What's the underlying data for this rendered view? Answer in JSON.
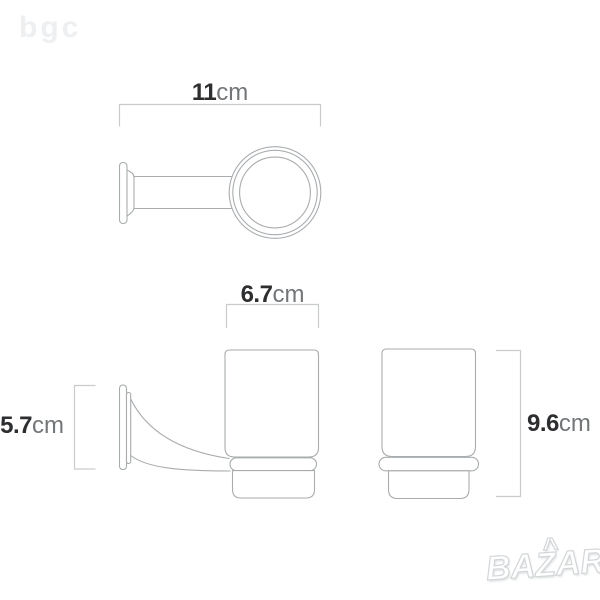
{
  "watermarks": {
    "top_left_logo": "bgc",
    "bottom_right_logo": "BAZAR",
    "bottom_right_logo_accent": "^"
  },
  "diagram": {
    "type": "product-dimension-drawing",
    "dimensions": [
      {
        "id": "holder-depth",
        "value": "11",
        "unit": "cm"
      },
      {
        "id": "cup-width",
        "value": "6.7",
        "unit": "cm"
      },
      {
        "id": "wall-plate-height",
        "value": "5.7",
        "unit": "cm"
      },
      {
        "id": "cup-height",
        "value": "9.6",
        "unit": "cm"
      }
    ]
  },
  "colors": {
    "background": "#ffffff",
    "drawing_line": "#a8acae",
    "dimension_line": "#c9cccd",
    "value_text": "#2d2e30",
    "unit_text": "#737678",
    "logo_gray": "#edeff1",
    "watermark_outline": "#d3d6d8"
  }
}
